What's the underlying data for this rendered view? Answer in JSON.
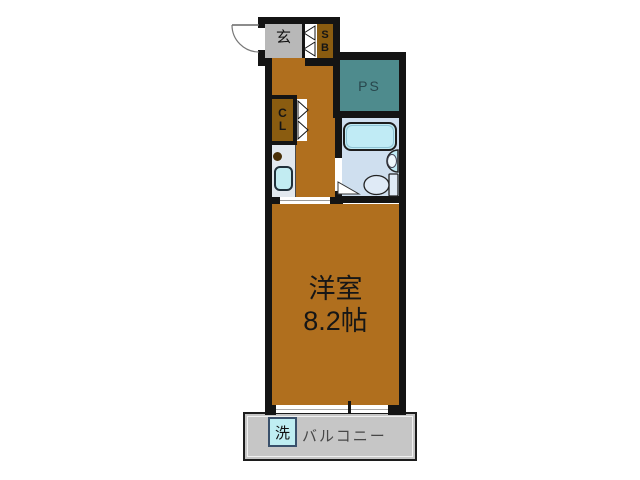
{
  "plan": {
    "entrance": {
      "label": "玄"
    },
    "shoe_box": {
      "top": "S",
      "bottom": "B"
    },
    "pipe_space": {
      "label": "PS"
    },
    "closet": {
      "top": "C",
      "bottom": "L"
    },
    "main_room": {
      "name": "洋室",
      "area": "8.2帖"
    },
    "washer": {
      "label": "洗"
    },
    "balcony": {
      "label": "バルコニー"
    },
    "colors": {
      "wall": "#141414",
      "wood_floor": "#b06f1e",
      "cabinet_amber": "#8a5c10",
      "pipe_space_teal": "#4e8b8d",
      "genkan_gray": "#b8b8b8",
      "balcony_gray": "#c6c6c6",
      "bath_floor_blue": "#cfdfef",
      "water_cyan": "#c0ebf5",
      "counter_gray": "#e2e8ee"
    }
  }
}
